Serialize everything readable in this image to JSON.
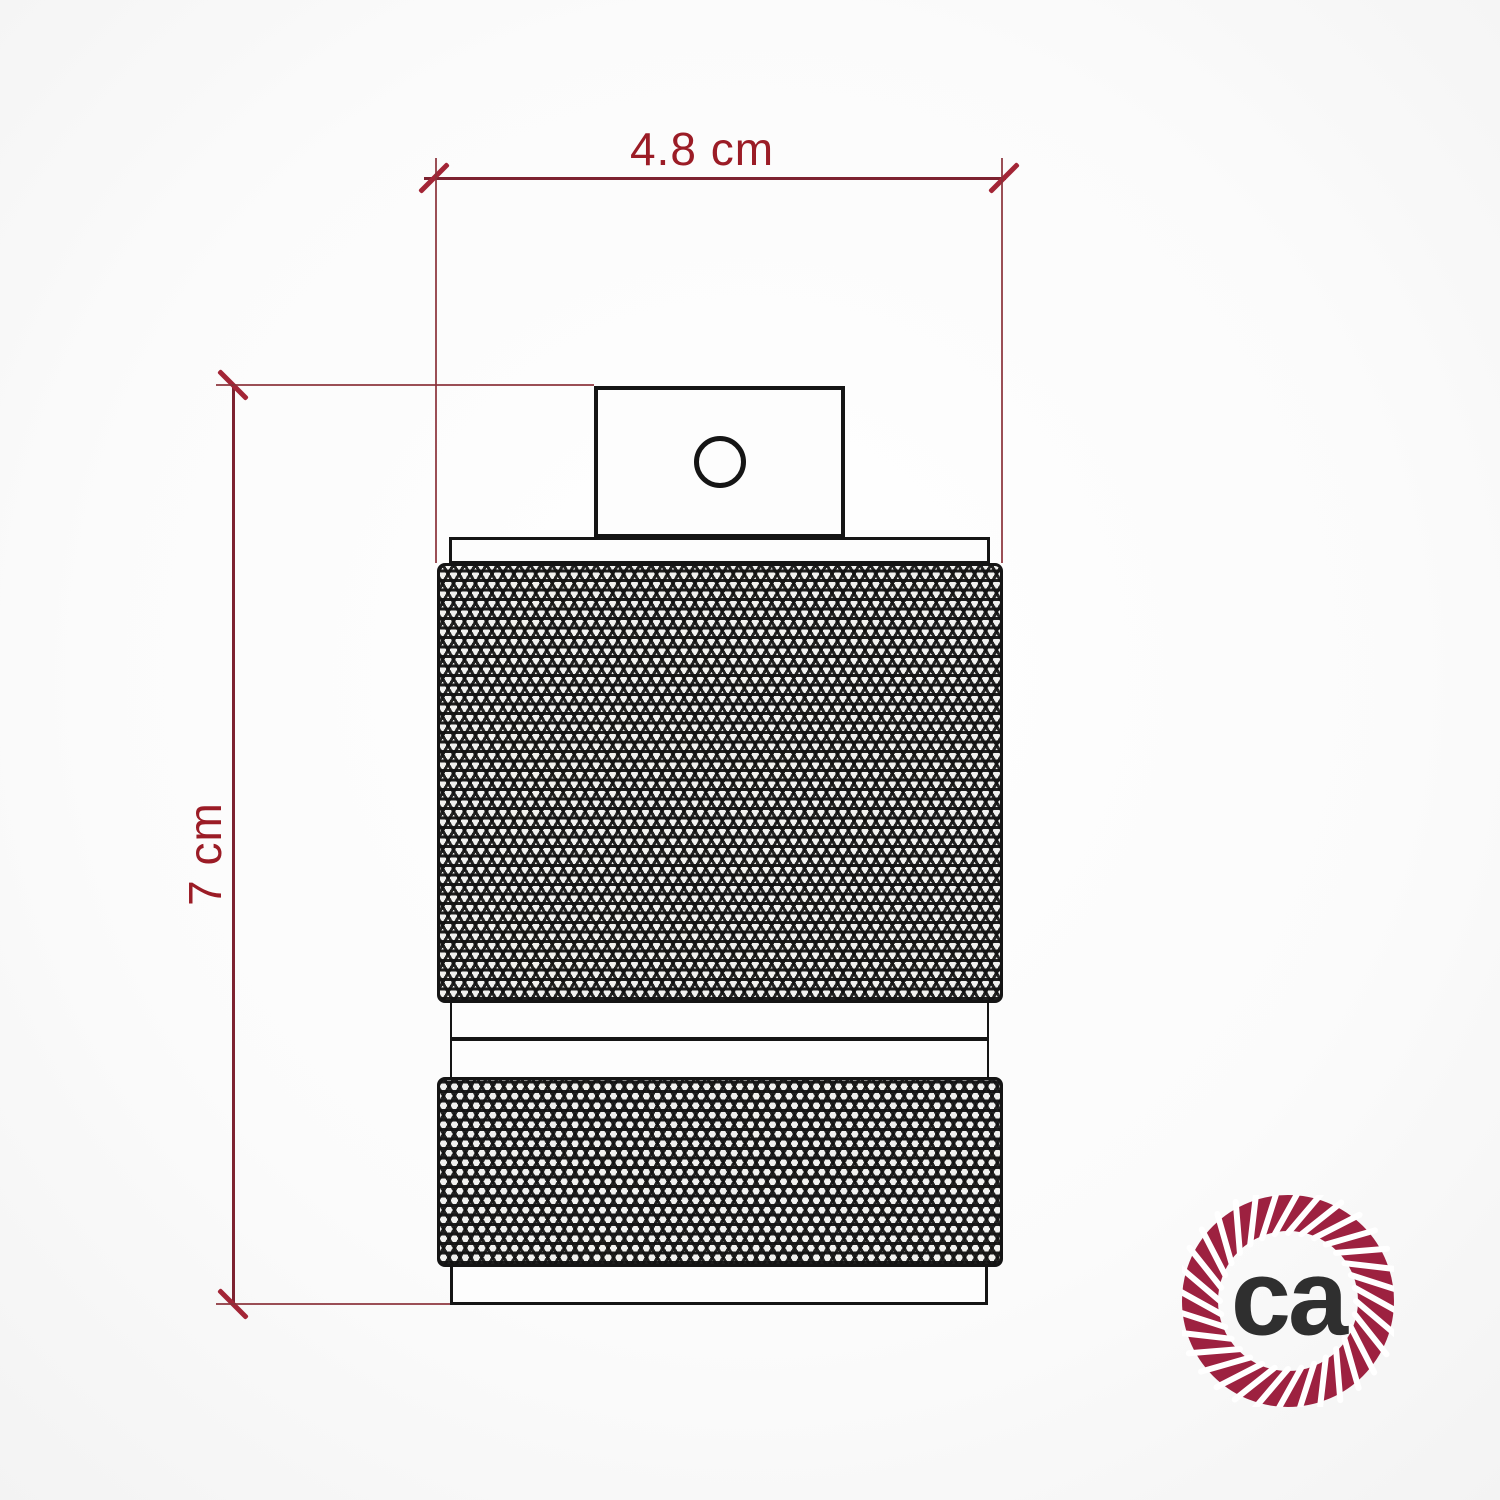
{
  "drawing": {
    "subject": "lamp-holder-socket-technical-drawing",
    "dimensions": {
      "width_label": "4.8 cm",
      "height_label": "7 cm"
    }
  },
  "logo": {
    "text": "ca"
  },
  "icons": {
    "logo_ring": "rope-circle-icon"
  },
  "colors": {
    "dim-line": "#7d2230",
    "dim-text": "#9b1c26",
    "tick": "#a32536",
    "ext-line": "#8a3038",
    "outline": "#151515",
    "knurl-bg": "#f1f1ef",
    "rope": "#9d2140",
    "logo-text": "#2f2f2f"
  }
}
